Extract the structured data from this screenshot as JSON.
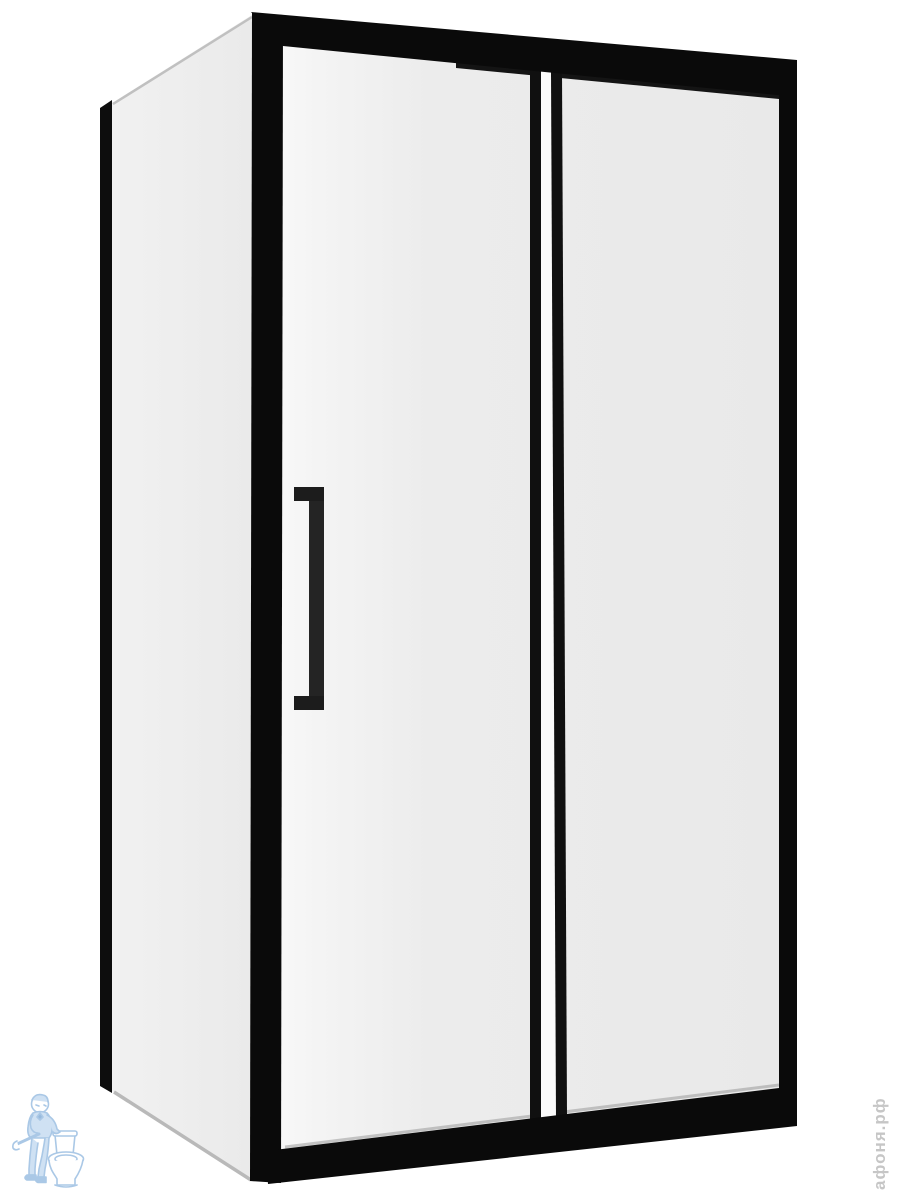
{
  "scene": {
    "subject": "shower-enclosure-black-frame-product-photo",
    "background_color": "#ffffff",
    "frame_color": "#0a0a0a",
    "front_glass_color": "#ececec",
    "side_glass_color": "#efefef",
    "glass_edge_line_color": "#bfbfbf",
    "handle_color": "#222222"
  },
  "watermarks": {
    "store_text": "афоня.рф",
    "store_text_color": "#c6c6c6",
    "logo_name": "plumber-with-toilet-logo",
    "logo_stroke_color": "#9cbfe2",
    "logo_fill_color": "#c7dcf1"
  }
}
